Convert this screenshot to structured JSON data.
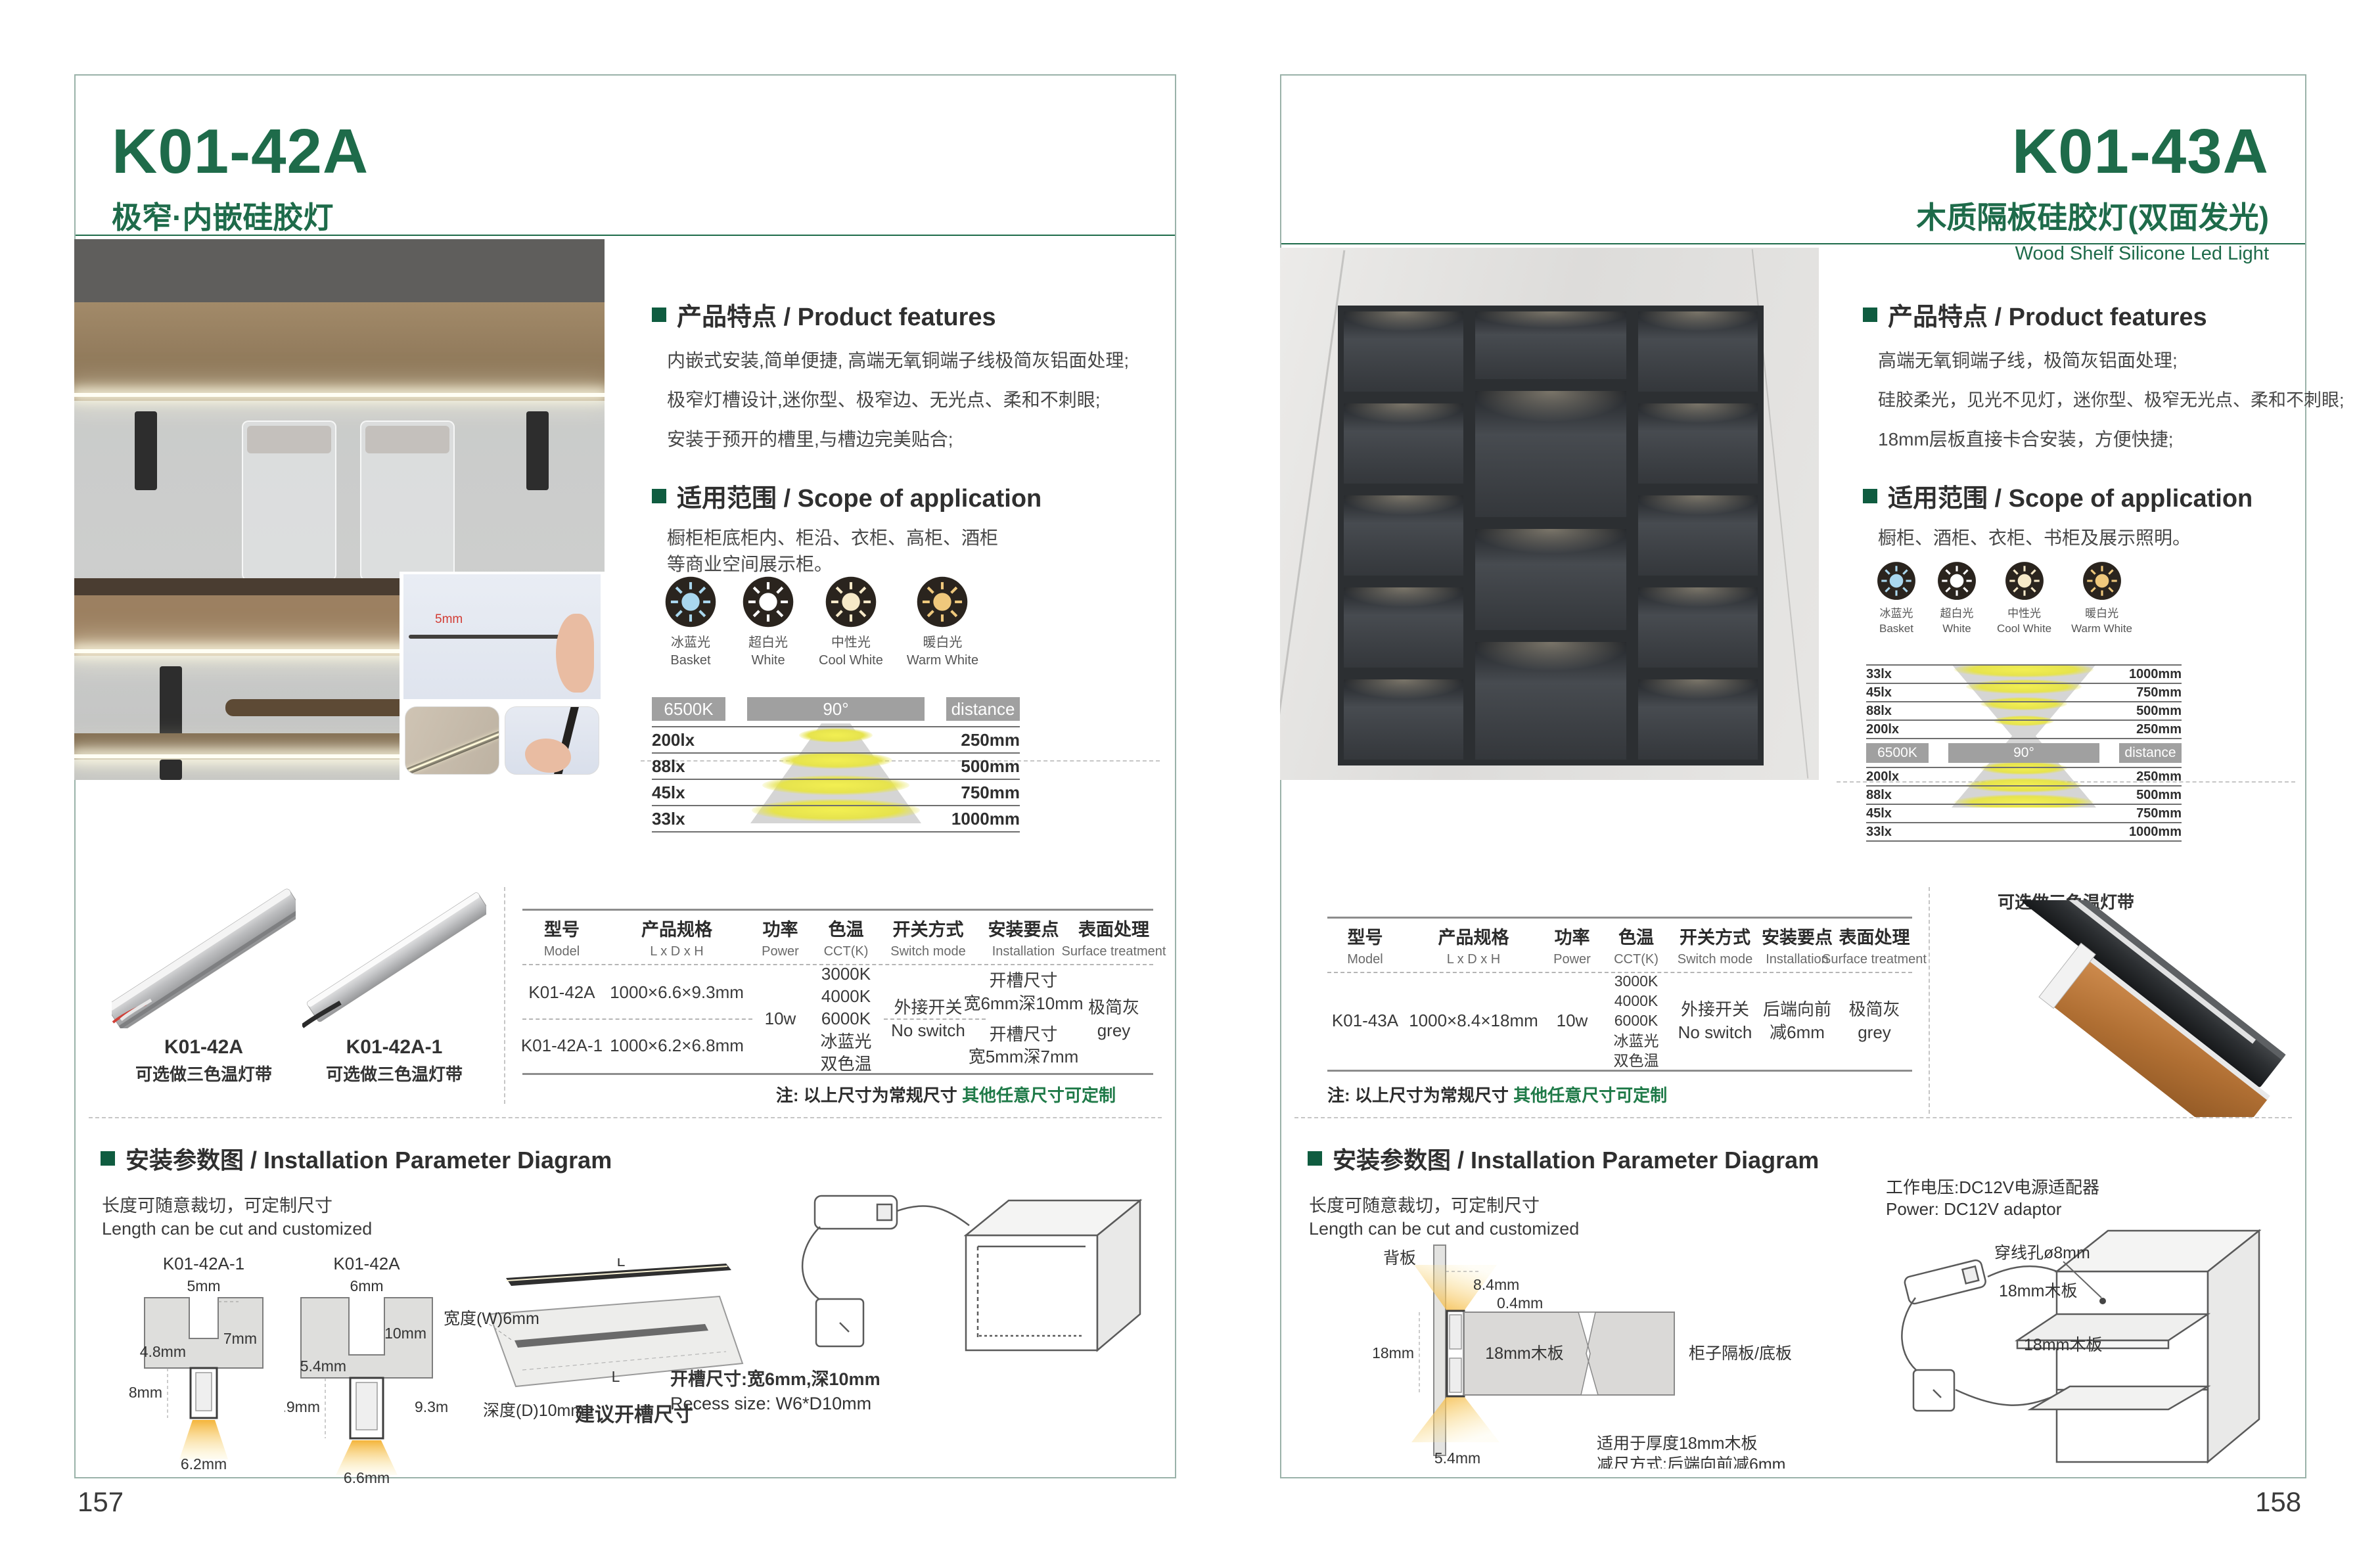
{
  "colors": {
    "green": "#1e6b4a",
    "bullet_green": "#0f5c40",
    "note_green": "#1f7a48",
    "badge_gray": "#a0a0a0",
    "frame": "#9ab2a9",
    "warm_light": "#f4c14e",
    "ice_blue": "#a9d7ee",
    "cream": "#f6e9c8",
    "warm_white": "#efc87c"
  },
  "light_modes": [
    {
      "cn": "冰蓝光",
      "en": "Basket",
      "color": "#a9d7ee"
    },
    {
      "cn": "超白光",
      "en": "White",
      "color": "#ffffff"
    },
    {
      "cn": "中性光",
      "en": "Cool White",
      "color": "#f6e9c8"
    },
    {
      "cn": "暖白光",
      "en": "Warm White",
      "color": "#efc87c"
    }
  ],
  "table_headers": [
    {
      "cn": "型号",
      "en": "Model"
    },
    {
      "cn": "产品规格",
      "en": "L x D x H"
    },
    {
      "cn": "功率",
      "en": "Power"
    },
    {
      "cn": "色温",
      "en": "CCT(K)"
    },
    {
      "cn": "开关方式",
      "en": "Switch mode"
    },
    {
      "cn": "安装要点",
      "en": "Installation"
    },
    {
      "cn": "表面处理",
      "en": "Surface treatment"
    }
  ],
  "left": {
    "page_number": "157",
    "model": "K01-42A",
    "title_cn": "极窄·内嵌硅胶灯",
    "title_en": "Extremely Narrow. Built-in Silicone Light",
    "features": {
      "heading": "产品特点 / Product features",
      "lines": [
        "内嵌式安装,简单便捷, 高端无氧铜端子线极简灰铝面处理;",
        "极窄灯槽设计,迷你型、极窄边、无光点、柔和不刺眼;",
        "安装于预开的槽里,与槽边完美贴合;"
      ]
    },
    "scope": {
      "heading": "适用范围 / Scope of application",
      "lines": [
        "橱柜柜底柜内、柜沿、衣柜、高柜、酒柜",
        "等商业空间展示柜。"
      ]
    },
    "photo": {
      "inset_dim": "5mm"
    },
    "photometry": {
      "cct": "6500K",
      "angle": "90°",
      "distance": "distance",
      "rows": [
        [
          "200lx",
          "250mm"
        ],
        [
          "88lx",
          "500mm"
        ],
        [
          "45lx",
          "750mm"
        ],
        [
          "33lx",
          "1000mm"
        ]
      ]
    },
    "products": [
      {
        "name": "K01-42A",
        "variant": "可选做三色温灯带"
      },
      {
        "name": "K01-42A-1",
        "variant": "可选做三色温灯带"
      }
    ],
    "table": {
      "rows": [
        {
          "model": "K01-42A",
          "spec": "1000×6.6×9.3mm",
          "slot1": "开槽尺寸",
          "slot2": "宽6mm深10mm"
        },
        {
          "model": "K01-42A-1",
          "spec": "1000×6.2×6.8mm",
          "slot1": "开槽尺寸",
          "slot2": "宽5mm深7mm"
        }
      ],
      "power": "10w",
      "cct": [
        "3000K",
        "4000K",
        "6000K",
        "冰蓝光",
        "双色温"
      ],
      "switch": [
        "外接开关",
        "No switch"
      ],
      "surface": [
        "极简灰",
        "grey"
      ]
    },
    "note": {
      "prefix": "注: 以上尺寸为常规尺寸 ",
      "highlight": "其他任意尺寸可定制"
    },
    "install": {
      "heading": "安装参数图 / Installation Parameter Diagram",
      "cut_cn": "长度可随意裁切，可定制尺寸",
      "cut_en": "Length can be cut and customized",
      "diagram_a": {
        "name": "K01-42A-1",
        "slot_w": "5mm",
        "slot_d": "7mm",
        "lip": "4.8mm",
        "h": "6.8mm",
        "w": "6.2mm"
      },
      "diagram_b": {
        "name": "K01-42A",
        "slot_w": "6mm",
        "slot_d": "10mm",
        "lip": "5.4mm",
        "h_left": "8.9mm",
        "h_right": "9.3mm",
        "w": "6.6mm"
      },
      "board": {
        "width_label": "宽度(W)6mm",
        "depth_label": "深度(D)10mm",
        "length_label": "L",
        "suggest": "建议开槽尺寸"
      },
      "recess_cn": "开槽尺寸:宽6mm,深10mm",
      "recess_en": "Recess size: W6*D10mm"
    }
  },
  "right": {
    "page_number": "158",
    "model": "K01-43A",
    "title_cn": "木质隔板硅胶灯(双面发光)",
    "title_en": "Wood Shelf Silicone Led Light",
    "features": {
      "heading": "产品特点 / Product features",
      "lines": [
        "高端无氧铜端子线，极简灰铝面处理;",
        "硅胶柔光，见光不见灯，迷你型、极窄无光点、柔和不刺眼;",
        "18mm层板直接卡合安装，方便快捷;"
      ]
    },
    "scope": {
      "heading": "适用范围 / Scope of application",
      "lines": [
        "橱柜、酒柜、衣柜、书柜及展示照明。"
      ]
    },
    "photometry": {
      "cct": "6500K",
      "angle": "90°",
      "distance": "distance",
      "rows_top": [
        [
          "33lx",
          "1000mm"
        ],
        [
          "45lx",
          "750mm"
        ],
        [
          "88lx",
          "500mm"
        ],
        [
          "200lx",
          "250mm"
        ]
      ],
      "rows_bottom": [
        [
          "200lx",
          "250mm"
        ],
        [
          "88lx",
          "500mm"
        ],
        [
          "45lx",
          "750mm"
        ],
        [
          "33lx",
          "1000mm"
        ]
      ]
    },
    "product_variant": "可选做三色温灯带",
    "table": {
      "row": {
        "model": "K01-43A",
        "spec": "1000×8.4×18mm",
        "power": "10w",
        "cct": [
          "3000K",
          "4000K",
          "6000K",
          "冰蓝光",
          "双色温"
        ],
        "switch": [
          "外接开关",
          "No switch"
        ],
        "install": [
          "后端向前",
          "减6mm"
        ],
        "surface": [
          "极简灰",
          "grey"
        ]
      }
    },
    "note": {
      "prefix": "注: 以上尺寸为常规尺寸 ",
      "highlight": "其他任意尺寸可定制"
    },
    "install": {
      "heading": "安装参数图 / Installation Parameter Diagram",
      "cut_cn": "长度可随意裁切，可定制尺寸",
      "cut_en": "Length can be cut and customized",
      "cross": {
        "back": "背板",
        "top_inset": "8.4mm",
        "gap": "0.4mm",
        "thickness": "18mm",
        "board": "18mm木板",
        "panel": "柜子隔板/底板",
        "bottom_inset": "5.4mm",
        "fit1": "适用于厚度18mm木板",
        "fit2": "减尺方式:后端向前减6mm"
      },
      "power_cn": "工作电压:DC12V电源适配器",
      "power_en": "Power: DC12V adaptor",
      "cabinet": {
        "hole": "穿线孔ø8mm",
        "shelf_top": "18mm木板",
        "shelf_bottom": "18mm木板"
      }
    }
  }
}
